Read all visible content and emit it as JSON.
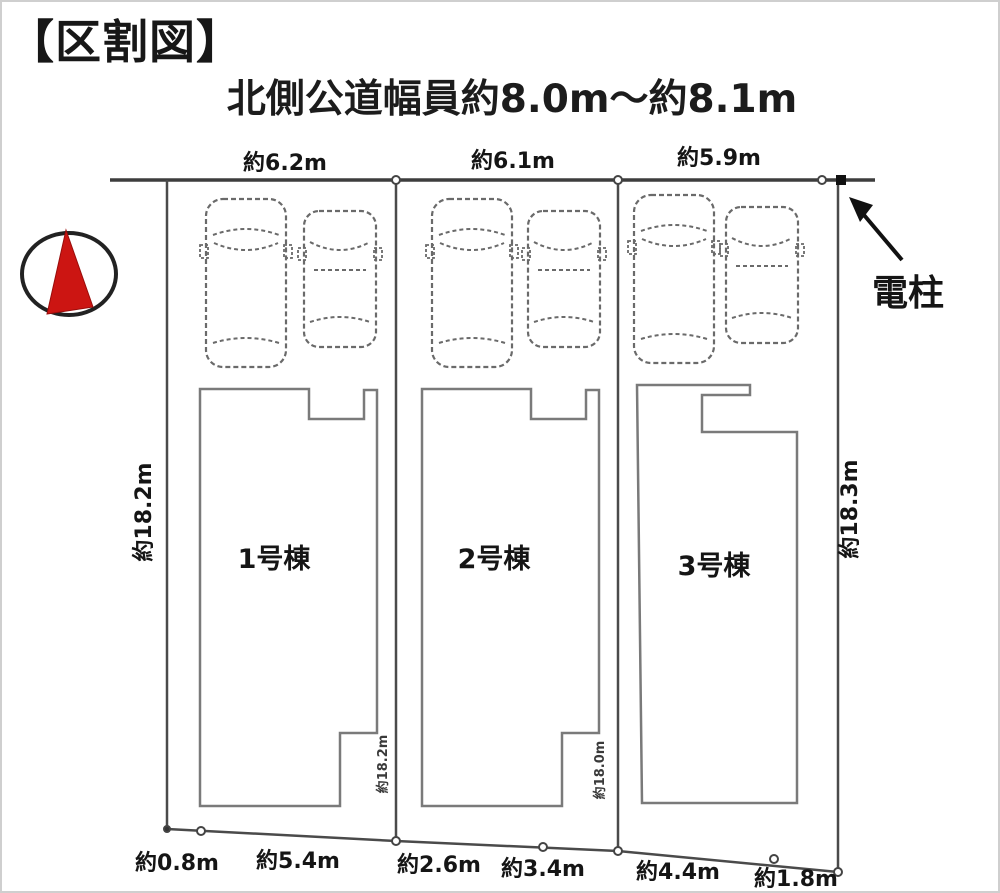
{
  "header": {
    "title": "【区割図】",
    "road_label": "北側公道幅員約8.0m～約8.1m"
  },
  "compass": {
    "name": "north-arrow"
  },
  "utility_pole": {
    "label": "電柱"
  },
  "lots": [
    {
      "name": "1号棟",
      "frontage": "約6.2m"
    },
    {
      "name": "2号棟",
      "frontage": "約6.1m"
    },
    {
      "name": "3号棟",
      "frontage": "約5.9m"
    }
  ],
  "depth_labels": {
    "left": "約18.2m",
    "inner_left": "約18.2m",
    "inner_right": "約18.0m",
    "right": "約18.3m"
  },
  "bottom_dims": [
    "約0.8m",
    "約5.4m",
    "約2.6m",
    "約3.4m",
    "約4.4m",
    "約1.8m"
  ],
  "colors": {
    "compass_red": "#cc1512",
    "line_gray": "#3d3d3d",
    "building_gray": "#7a7a7a",
    "text_black": "#111111"
  }
}
